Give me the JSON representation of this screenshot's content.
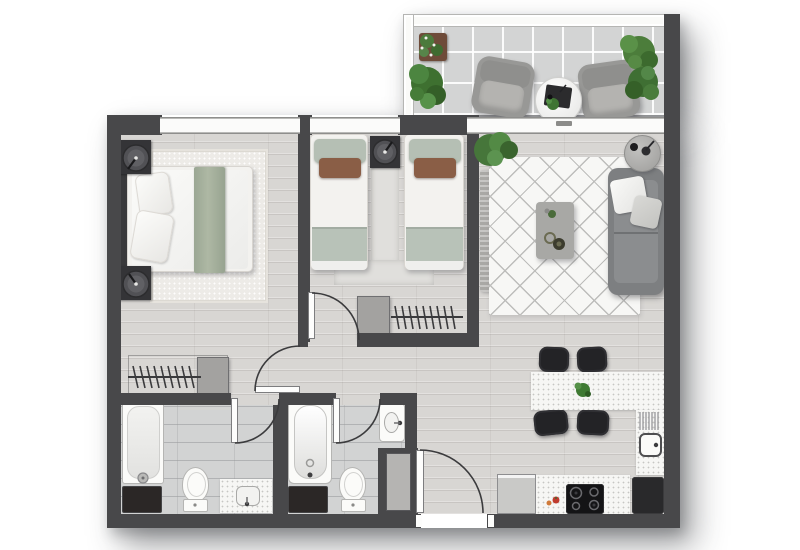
{
  "meta": {
    "title": "apartment-floor-plan",
    "view": "top-down-architectural-rendering",
    "canvas": {
      "width": 800,
      "height": 550
    },
    "visible_text": "none"
  },
  "palette": {
    "background": "#ffffff",
    "wall": "#48484a",
    "wood_floor": "#d8d6d3",
    "bathroom_tile": "#d2d3d3",
    "balcony_tile": "#d3d4d4",
    "window_frame": "#fbfbfa",
    "counter_white": "#f6f6f4",
    "sofa_gray": "#7d7f81",
    "chair_black": "#232326",
    "sage_green": "#b3bfb5",
    "accent_brown": "#8a5e46",
    "plant_green": "#467c38",
    "dark_cabinet": "#2b2726"
  },
  "rooms": [
    {
      "id": "balcony",
      "label": "Balcony",
      "floor": "tile",
      "furniture": [
        "outdoor-armchair",
        "outdoor-armchair",
        "round-coffee-table",
        "serving-tray",
        "flower-pot",
        "fern-plant",
        "bush-plant",
        "bush-plant"
      ]
    },
    {
      "id": "master-bedroom",
      "label": "Master Bedroom",
      "floor": "wood",
      "furniture": [
        "double-bed",
        "headboard",
        "pillows",
        "green-throw",
        "nightstand-with-lamp",
        "nightstand-with-lamp",
        "area-rug",
        "closet-rack-hangers",
        "closet-cabinet"
      ]
    },
    {
      "id": "bedroom-2",
      "label": "Second Bedroom",
      "floor": "wood",
      "furniture": [
        "twin-bed",
        "twin-bed",
        "shared-nightstand-with-lamp",
        "runner-rug",
        "closet-rack-hangers",
        "closet-cabinet"
      ]
    },
    {
      "id": "living-room",
      "label": "Living Room",
      "floor": "wood",
      "furniture": [
        "sofa",
        "throw-pillows",
        "coffee-table",
        "diamond-pattern-rug",
        "round-side-table",
        "console-sideboard",
        "potted-plant"
      ]
    },
    {
      "id": "dining-area",
      "label": "Dining Area",
      "floor": "wood",
      "furniture": [
        "dining-peninsula-table",
        "dining-chair",
        "dining-chair",
        "dining-chair",
        "dining-chair",
        "plant-centerpiece"
      ]
    },
    {
      "id": "kitchen",
      "label": "Kitchen",
      "floor": "wood",
      "furniture": [
        "l-shaped-counter",
        "kitchen-sink",
        "dish-rack",
        "cooktop-4-burners",
        "refrigerator",
        "dark-base-cabinet",
        "tomatoes"
      ]
    },
    {
      "id": "bathroom-1",
      "label": "Bathroom 1 (ensuite)",
      "floor": "tile",
      "furniture": [
        "shower-tray",
        "toilet",
        "vanity-sink",
        "dark-cabinet"
      ]
    },
    {
      "id": "bathroom-2",
      "label": "Bathroom 2",
      "floor": "tile",
      "furniture": [
        "bathtub",
        "toilet",
        "wall-sink",
        "dark-cabinet"
      ]
    },
    {
      "id": "hallway",
      "label": "Hallway",
      "floor": "wood",
      "furniture": []
    },
    {
      "id": "entry",
      "label": "Entry",
      "floor": "wood",
      "furniture": [
        "utility-closet"
      ]
    }
  ],
  "doors": [
    {
      "id": "master-bedroom-door",
      "label": "Master bedroom door",
      "type": "swing"
    },
    {
      "id": "bedroom-2-door",
      "label": "Second bedroom door",
      "type": "swing"
    },
    {
      "id": "bathroom-1-door",
      "label": "Bathroom 1 door",
      "type": "swing"
    },
    {
      "id": "bathroom-2-door",
      "label": "Bathroom 2 door",
      "type": "swing"
    },
    {
      "id": "entry-door",
      "label": "Apartment entry door",
      "type": "swing"
    }
  ],
  "windows": [
    {
      "id": "master-bedroom-window",
      "label": "Master bedroom window"
    },
    {
      "id": "bedroom-2-window",
      "label": "Second bedroom window"
    },
    {
      "id": "balcony-slider",
      "label": "Living room sliding door to balcony"
    }
  ]
}
